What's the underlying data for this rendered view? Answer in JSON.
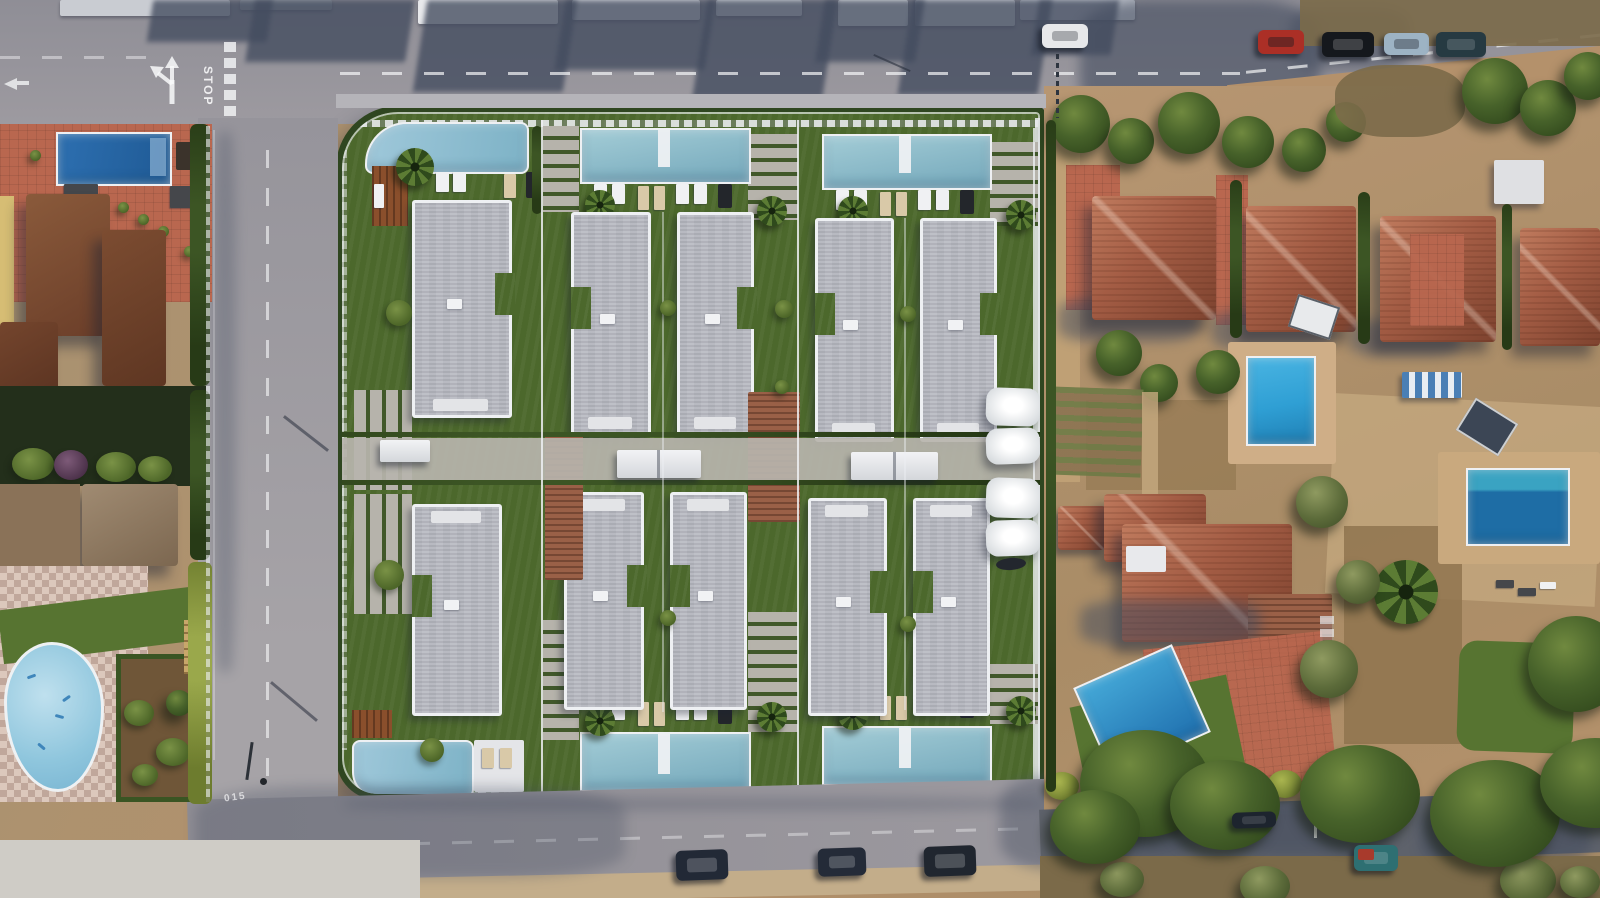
{
  "scene": {
    "title": "Aerial drone view - new-build townhouse development with private pools",
    "setting": "Top-down photo of a Mediterranean residential block; a rendered gated complex of modern white townhouses is overlaid in the centre, surrounded by existing villas, streets and gardens",
    "development": {
      "label": "new townhouse complex render",
      "rows": 2,
      "units_per_row": 5,
      "total_units": 10,
      "features": [
        "private lap pool per unit",
        "sun loungers",
        "palm trees",
        "lawn gardens",
        "grass-paver driveways",
        "timber pergolas",
        "white entrance canopies",
        "white shade sails",
        "perimeter hedge with white fence"
      ]
    },
    "surroundings": {
      "left": "existing villas with brown tiled roofs, red-tiled terrace with dark blue pool, shaded garden, communal free-form pool with checkered paving and vegetable plot",
      "right": "detached villas with terracotta hip roofs, gardens, bright blue pool, covered pool, tilted blue pool with lawn, dirt plots and olive trees",
      "top": "avenue with roadside buildings casting long shadows, parked cars and lane markings",
      "bottom": "street with parked dark cars, kerbside dirt strip and dense trees on the right"
    }
  },
  "road_markings": {
    "stop": "STOP",
    "road_id": "015",
    "lane_arrow": "straight-or-left fork arrow",
    "center_lines": "white dashed centre lines on all streets"
  },
  "pools": {
    "development_pools": 10,
    "left_villa_pool": "rectangular dark blue",
    "left_community_pool": "free-form light blue with painted motifs",
    "right_upper_pool": "bright azure rectangular",
    "right_lower_pool": "dark blue, partly covered teal",
    "right_bottom_pool": "tilted azure rectangular on lawn"
  },
  "cars": {
    "top_row": [
      {
        "label": "red car",
        "color": "#ab2f26"
      },
      {
        "label": "black car",
        "color": "#15181d"
      },
      {
        "label": "silver-blue car",
        "color": "#9db3c4"
      },
      {
        "label": "dark teal car",
        "color": "#263a42"
      }
    ],
    "top_center": {
      "label": "white car",
      "color": "#e7e8ea"
    },
    "bottom_row": [
      {
        "label": "dark parked car 1",
        "color": "#222936"
      },
      {
        "label": "dark parked car 2",
        "color": "#242b38"
      },
      {
        "label": "dark parked car 3",
        "color": "#20262f"
      }
    ],
    "right_lane": {
      "label": "car under tree shade",
      "color": "#1d242e"
    },
    "bottom_right": {
      "label": "teal vehicle with red load",
      "color": "#2e6f72",
      "accent": "#a83a2c"
    }
  },
  "palette": {
    "road": "#98969c",
    "road_shade": "#434c5f",
    "sand": "#b4916b",
    "sand_light": "#c6aa80",
    "dirt": "#8f744f",
    "brush": "#7b6a49",
    "lawn": "#4c682c",
    "lawn_bright": "#577431",
    "hedge_dark": "#2c431c",
    "hedge_bright": "#8e9c40",
    "tree_light": "#70893f",
    "tree_mid": "#47622a",
    "tree_dark": "#2a4018",
    "pool_light": "#a3ccd6",
    "pool_deep": "#74a8bb",
    "pool_azure": "#2f9fd4",
    "pool_navy": "#2d6fb0",
    "pool_dark": "#1e6da5",
    "pool_cover": "#3aa3c2",
    "roof_gray": "#babcc4",
    "wall_white": "#eef0f3",
    "terra_light": "#c07b5e",
    "terra": "#a35c44",
    "terra_dark": "#7e432f",
    "brick": "#8d6d55",
    "wood": "#8a4f2c",
    "lterrace": "#b9674f",
    "check_a": "#dcc8bc",
    "check_b": "#c0a79b",
    "walk": "#b7b4ac",
    "marking": "#f2f3f5"
  }
}
